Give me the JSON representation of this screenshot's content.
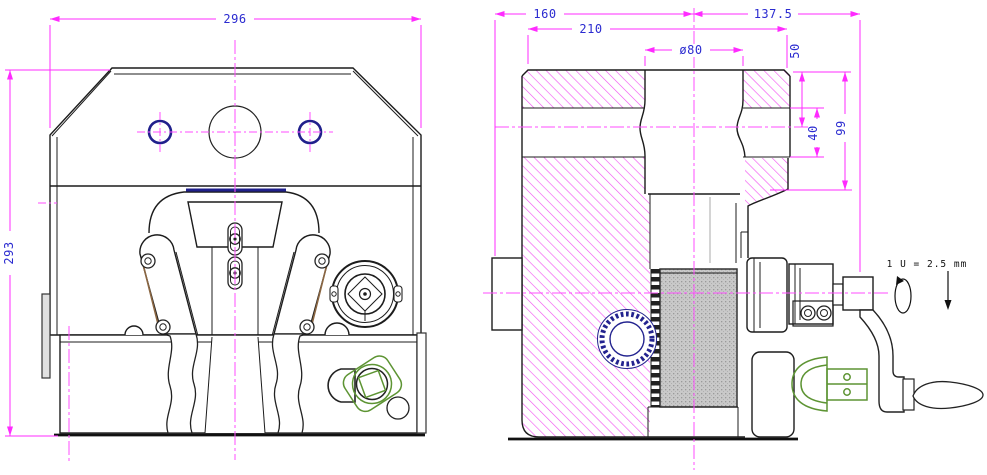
{
  "labels": {
    "front_width": "296",
    "front_height": "293",
    "side_left_span": "160",
    "side_right_span": "137.5",
    "side_inner_span": "210",
    "bore_diameter": "ø80",
    "depth_50": "50",
    "depth_40": "40",
    "depth_99": "99",
    "crank_ratio": "1 U = 2.5 mm"
  },
  "colors": {
    "dimension_line": "#ff2bff",
    "dimension_text": "#2b2bd0",
    "centerline": "#ff4dff",
    "hatch": "#f24df2",
    "hole_accent": "#20208c",
    "green_part": "#5d9433",
    "brown_edge": "#8a6642",
    "outline": "#1c1c1c",
    "annotation_text": "#111111",
    "thread_fill": "#c9c9c9"
  }
}
